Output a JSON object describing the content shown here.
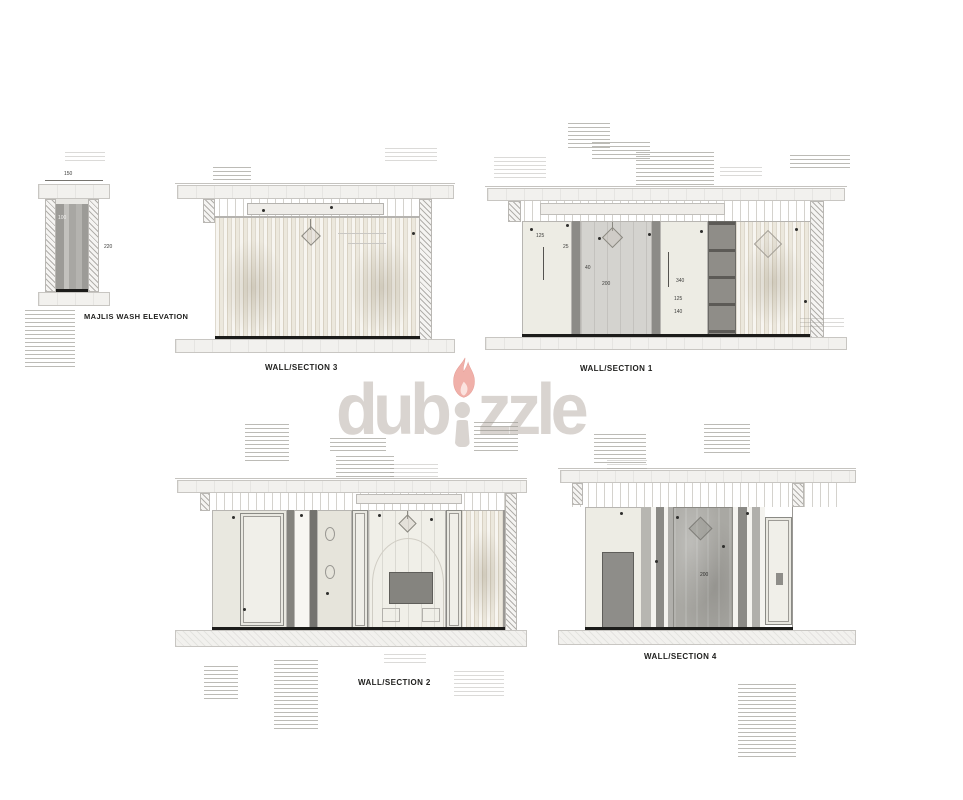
{
  "watermark": {
    "left": "dub",
    "right": "zzle",
    "text_color": "#d9d4d0",
    "flame_color": "#f0b0a9"
  },
  "drawings": {
    "majlis": {
      "title": "MAJLIS WASH ELEVATION",
      "dims": {
        "width": "150",
        "height": "220",
        "inner": "100"
      }
    },
    "section3": {
      "title": "WALL/SECTION 3"
    },
    "section1": {
      "title": "WALL/SECTION 1",
      "dims": {
        "a": "125",
        "b": "25",
        "c": "40",
        "d": "200",
        "e": "340",
        "f": "125",
        "g": "140"
      }
    },
    "section2": {
      "title": "WALL/SECTION 2"
    },
    "section4": {
      "title": "WALL/SECTION 4",
      "dims": {
        "a": "200"
      }
    }
  }
}
